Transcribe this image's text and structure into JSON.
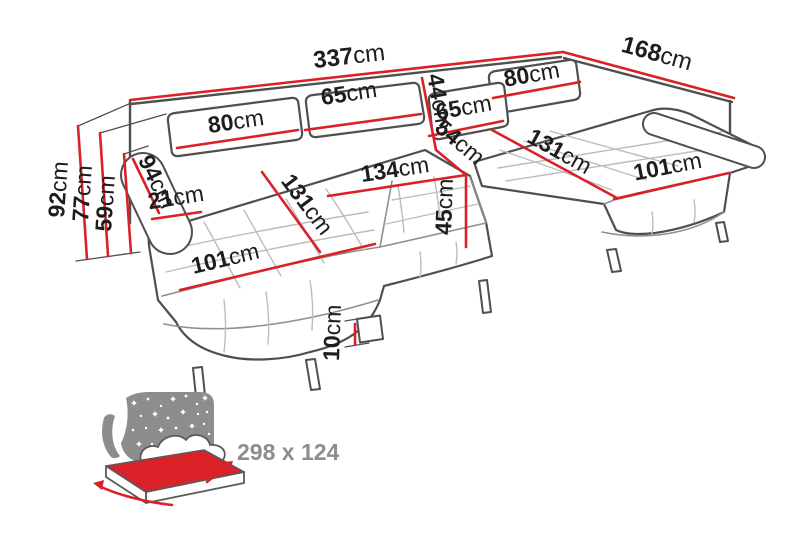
{
  "dims": {
    "overall_width": {
      "value": "337",
      "unit": "cm"
    },
    "overall_depth": {
      "value": "168",
      "unit": "cm"
    },
    "overall_height": {
      "value": "92",
      "unit": "cm"
    },
    "back_height": {
      "value": "77",
      "unit": "cm"
    },
    "armrest_height": {
      "value": "59",
      "unit": "cm"
    },
    "back_cushion_left": {
      "value": "80",
      "unit": "cm"
    },
    "back_cushion_mid": {
      "value": "65",
      "unit": "cm"
    },
    "back_cushion_depth": {
      "value": "44",
      "unit": "cm"
    },
    "back_cushion_right_inner": {
      "value": "65",
      "unit": "cm"
    },
    "back_cushion_right": {
      "value": "80",
      "unit": "cm"
    },
    "corner_seat": {
      "value": "54",
      "unit": "cm"
    },
    "mid_seat_width": {
      "value": "134",
      "unit": "cm"
    },
    "seat_height": {
      "value": "45",
      "unit": "cm"
    },
    "chaise_left_length": {
      "value": "131",
      "unit": "cm"
    },
    "chaise_right_length": {
      "value": "131",
      "unit": "cm"
    },
    "chaise_left_width": {
      "value": "101",
      "unit": "cm"
    },
    "chaise_right_width": {
      "value": "101",
      "unit": "cm"
    },
    "armrest_length": {
      "value": "94",
      "unit": "cm"
    },
    "armrest_width": {
      "value": "21",
      "unit": "cm"
    },
    "leg_height": {
      "value": "10",
      "unit": "cm"
    }
  },
  "sleeper": {
    "size_label": "298 x 124"
  },
  "colors": {
    "dimension_red": "#da2128",
    "label_black": "#1d1d1b",
    "sofa_outline_gray": "#4f4f4f",
    "icon_gray": "#8d8d8d",
    "background": "#ffffff"
  }
}
